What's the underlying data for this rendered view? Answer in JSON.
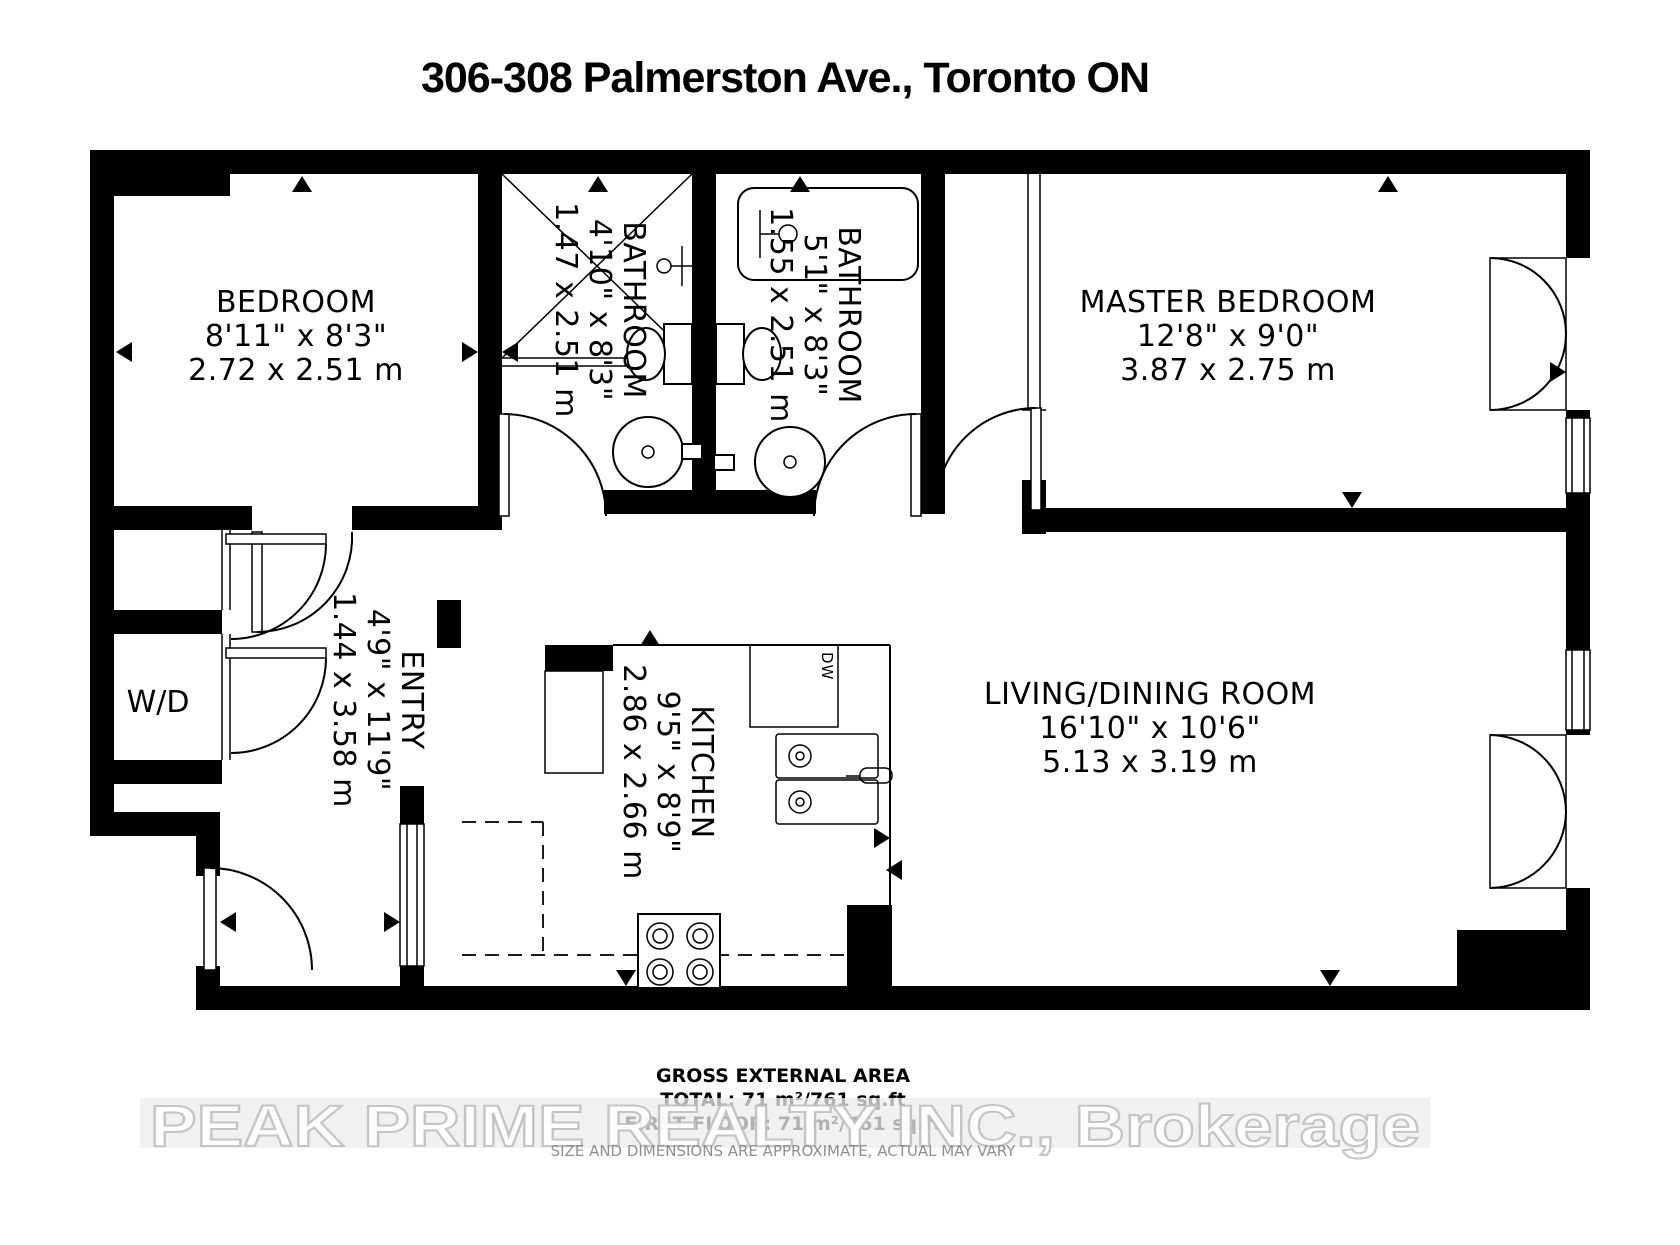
{
  "title": "306-308 Palmerston Ave., Toronto ON",
  "rooms": {
    "bedroom": {
      "name": "BEDROOM",
      "imperial": "8'11\" x 8'3\"",
      "metric": "2.72 x 2.51 m"
    },
    "bathroom1": {
      "name": "BATHROOM",
      "imperial": "4'10\" x 8'3\"",
      "metric": "1.47 x 2.51 m"
    },
    "bathroom2": {
      "name": "BATHROOM",
      "imperial": "5'1\" x 8'3\"",
      "metric": "1.55 x 2.51 m"
    },
    "master_bedroom": {
      "name": "MASTER BEDROOM",
      "imperial": "12'8\" x 9'0\"",
      "metric": "3.87 x 2.75 m"
    },
    "entry": {
      "name": "ENTRY",
      "imperial": "4'9\" x 11'9\"",
      "metric": "1.44 x 3.58 m"
    },
    "kitchen": {
      "name": "KITCHEN",
      "imperial": "9'5\" x 8'9\"",
      "metric": "2.86 x 2.66 m"
    },
    "living_dining": {
      "name": "LIVING/DINING ROOM",
      "imperial": "16'10\" x 10'6\"",
      "metric": "5.13 x 3.19 m"
    }
  },
  "labels": {
    "washer_dryer": "W/D",
    "dishwasher": "DW"
  },
  "footer": {
    "area_heading": "GROSS EXTERNAL AREA",
    "total": "TOTAL: 71 m²/761 sq.ft",
    "first_floor": "FIRST FLOOR: 71 m²/761 sq.ft",
    "disclaimer": "SIZE AND DIMENSIONS ARE APPROXIMATE, ACTUAL MAY VARY",
    "watermark": "PEAK PRIME REALTY INC., Brokerage"
  },
  "colors": {
    "wall": "#000000",
    "background": "#ffffff",
    "watermark_fill": "#ffffff",
    "watermark_stroke": "#c0c0c0",
    "disclaimer_text": "#8f8f8f"
  }
}
